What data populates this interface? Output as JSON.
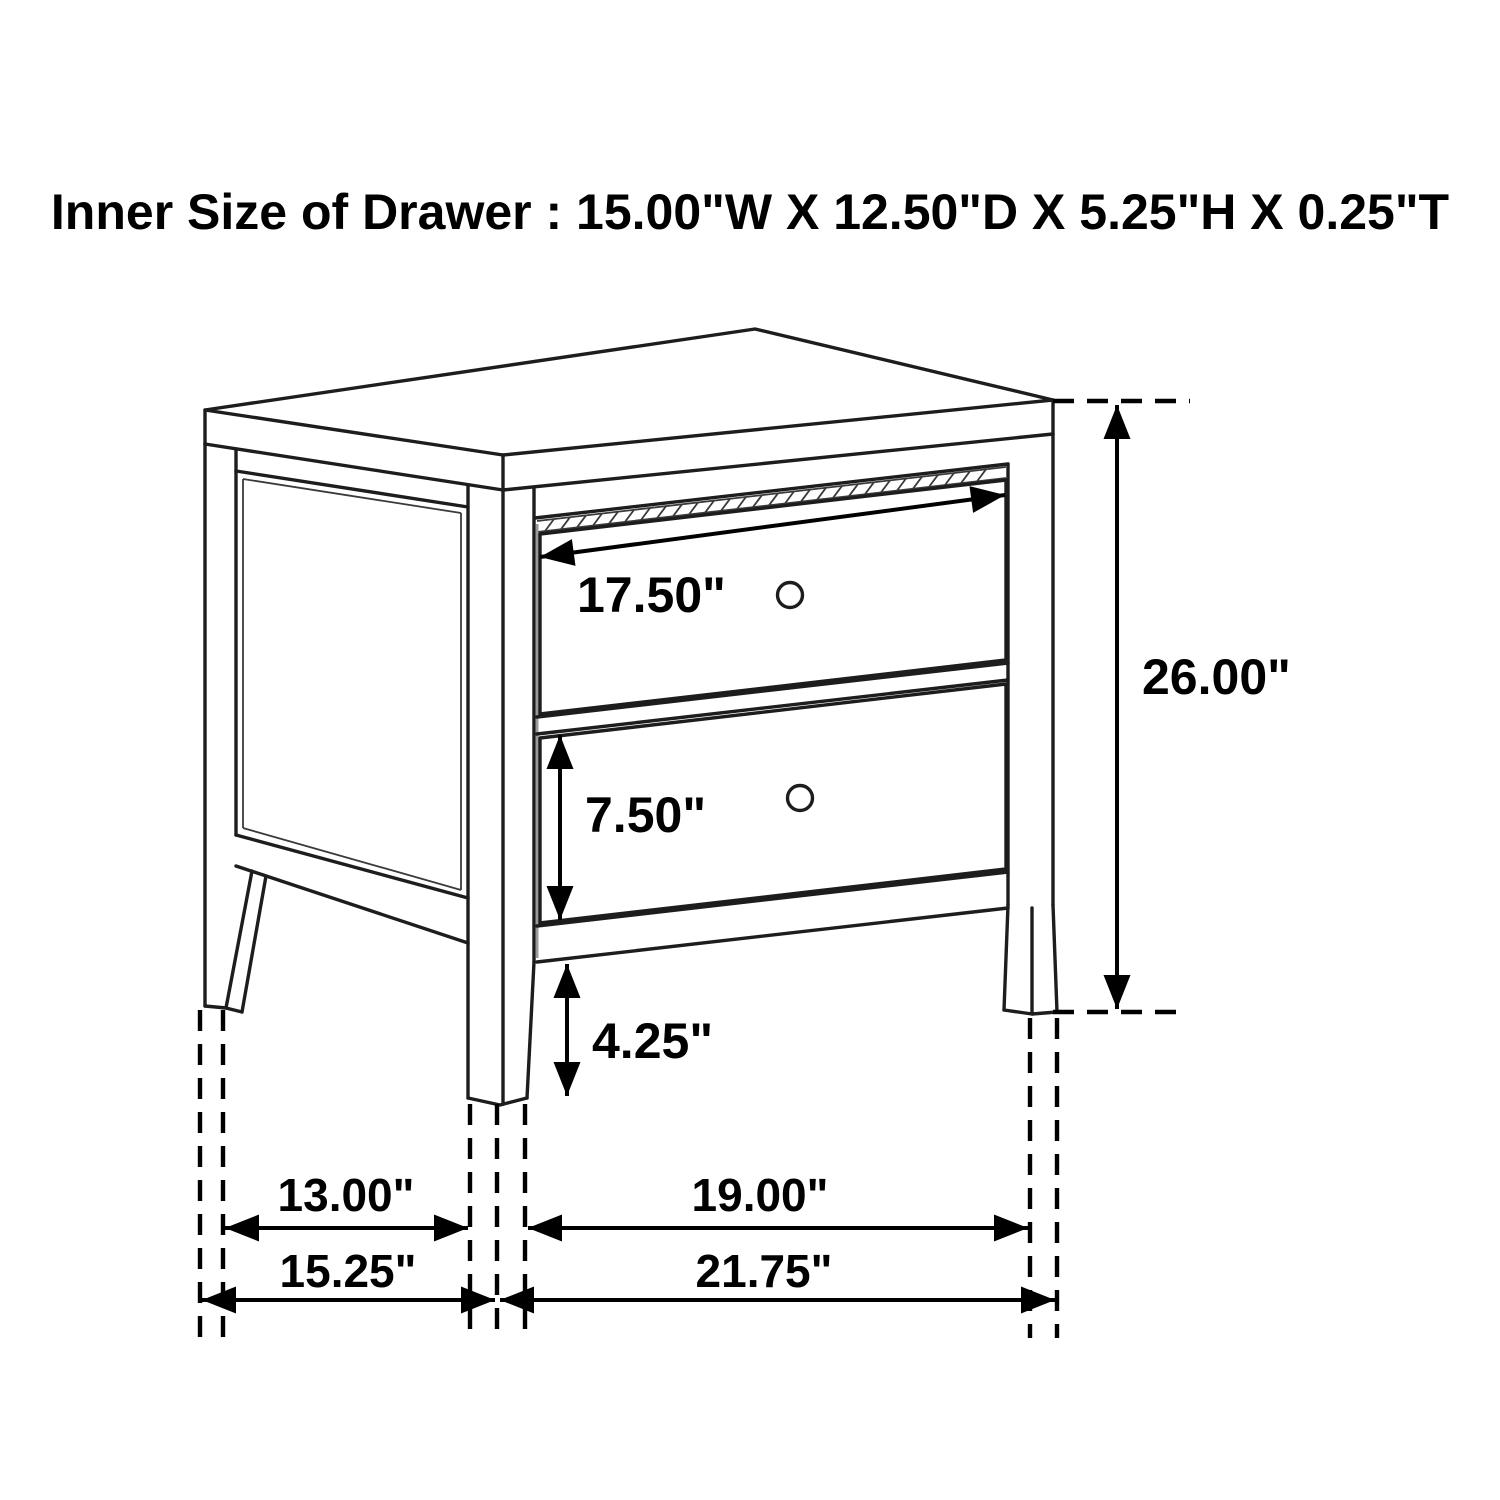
{
  "title": "Inner Size of Drawer : 15.00\"W X 12.50\"D X 5.25\"H X 0.25\"T",
  "inner_drawer_size": {
    "width": "15.00\"W",
    "depth": "12.50\"D",
    "height": "5.25\"H",
    "thickness": "0.25\"T"
  },
  "unit": "inches",
  "dimensions": {
    "drawer_face_width": {
      "label": "17.50\"",
      "value_in": 17.5
    },
    "overall_height": {
      "label": "26.00\"",
      "value_in": 26.0
    },
    "lower_drawer_height": {
      "label": "7.50\"",
      "value_in": 7.5
    },
    "leg_clearance_height": {
      "label": "4.25\"",
      "value_in": 4.25
    },
    "side_leg_spacing": {
      "label": "13.00\"",
      "value_in": 13.0
    },
    "front_leg_spacing": {
      "label": "19.00\"",
      "value_in": 19.0
    },
    "overall_depth": {
      "label": "15.25\"",
      "value_in": 15.25
    },
    "overall_width": {
      "label": "21.75\"",
      "value_in": 21.75
    }
  },
  "figure": {
    "subject": "2-drawer nightstand dimension diagram",
    "drawer_count": 2
  },
  "colors": {
    "background": "#ffffff",
    "line": "#1d1d1d",
    "text": "#000000"
  }
}
